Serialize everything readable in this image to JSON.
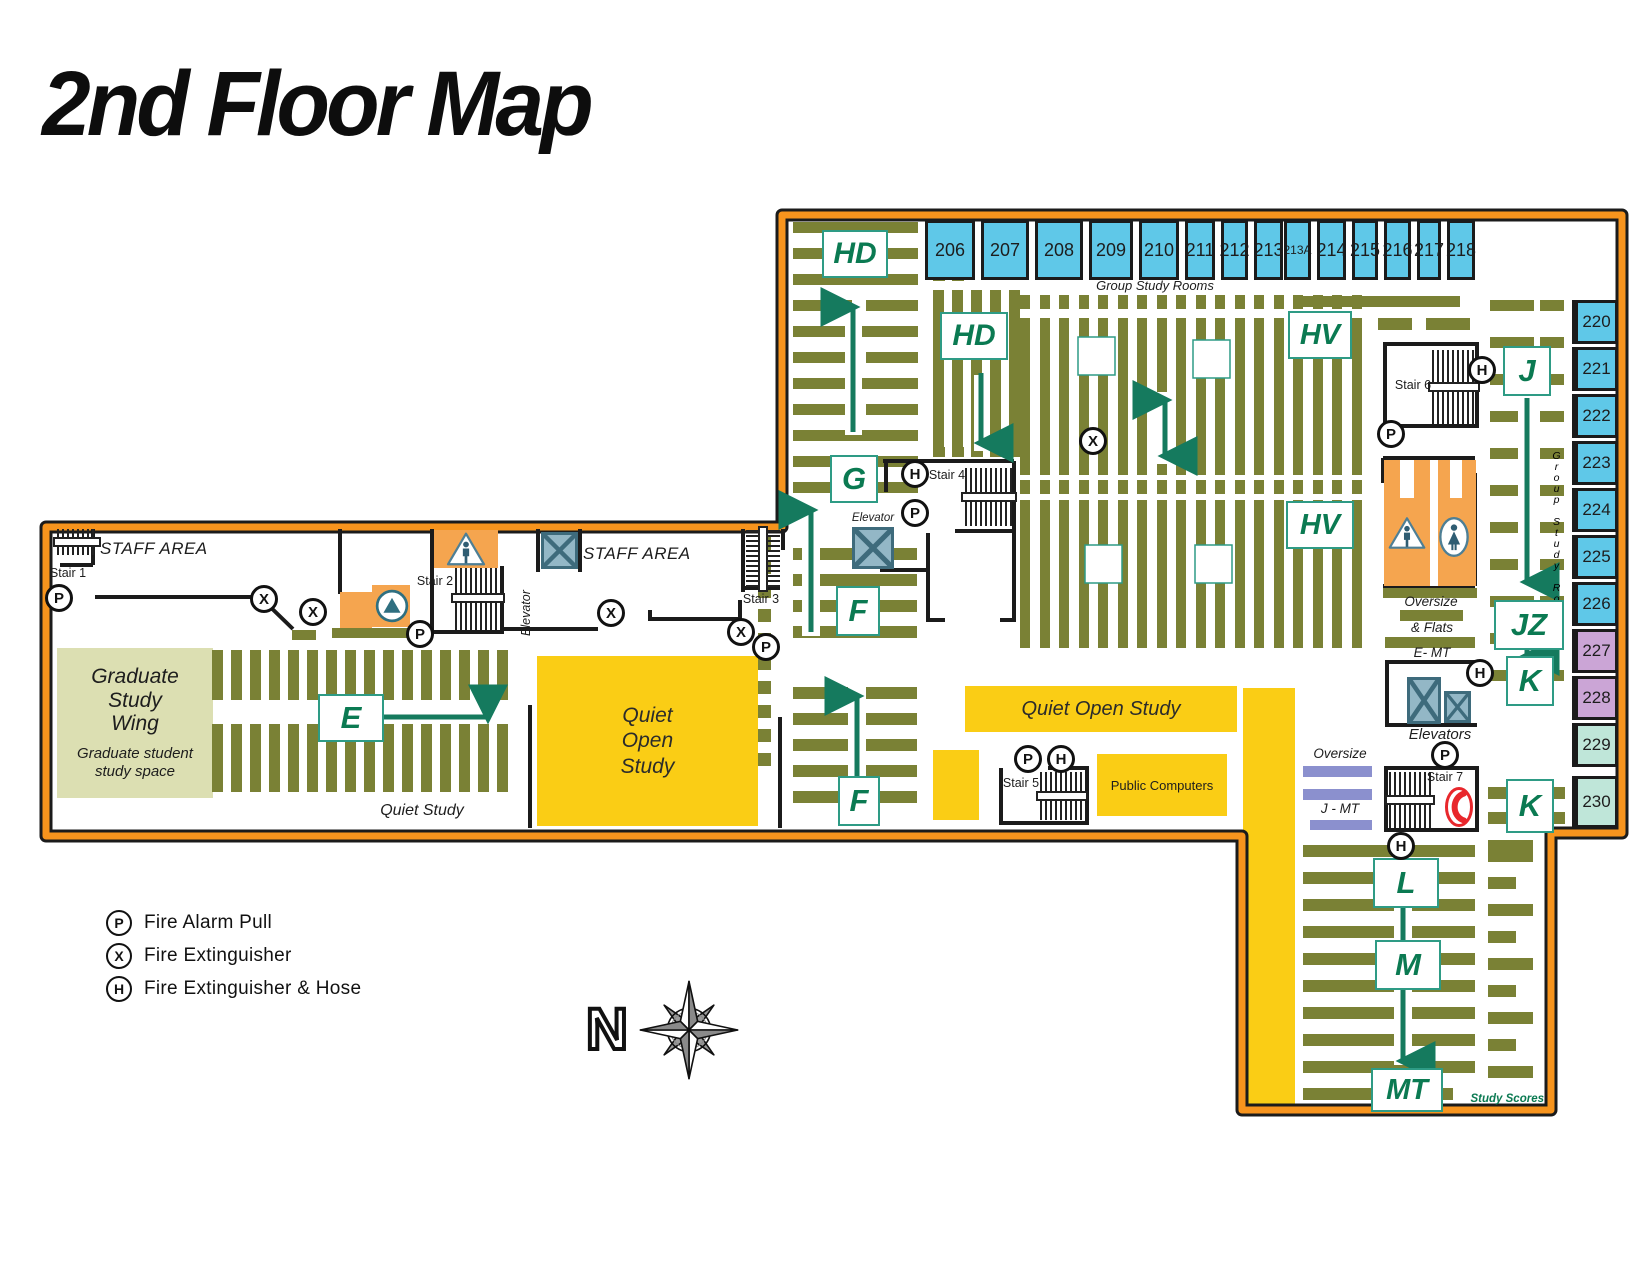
{
  "title": "2nd Floor Map",
  "rooms": {
    "top": [
      "206",
      "207",
      "208",
      "209",
      "210",
      "211",
      "212",
      "213",
      "213A",
      "214",
      "215",
      "216",
      "217",
      "218"
    ],
    "top_caption": "Group Study Rooms",
    "right": [
      "220",
      "221",
      "222",
      "223",
      "224",
      "225",
      "226",
      "227",
      "228",
      "229",
      "230"
    ],
    "right_caption": "Group Study Rooms"
  },
  "call_numbers": {
    "hd1": "HD",
    "hd2": "HD",
    "g": "G",
    "f1": "F",
    "f2": "F",
    "e": "E",
    "hv1": "HV",
    "hv2": "HV",
    "j": "J",
    "jz": "JZ",
    "k1": "K",
    "k2": "K",
    "l": "L",
    "m": "M",
    "mt": "MT"
  },
  "areas": {
    "graduate_title": "Graduate\nStudy\nWing",
    "graduate_subtitle": "Graduate student\nstudy space",
    "quiet_study": "Quiet Study",
    "quiet_open_study_main": "Quiet\nOpen\nStudy",
    "quiet_open_study_bar": "Quiet Open Study",
    "public_computers": "Public Computers",
    "study_scores": "Study Scores",
    "staff_area_1": "STAFF AREA",
    "staff_area_2": "STAFF AREA",
    "oversize_1": "Oversize",
    "flats": "& Flats",
    "e_mt": "E- MT",
    "oversize_2": "Oversize",
    "j_mt": "J - MT"
  },
  "facilities": {
    "stairs": [
      "Stair 1",
      "Stair 2",
      "Stair 3",
      "Stair 4",
      "Stair 5",
      "Stair 6",
      "Stair 7"
    ],
    "elevator_wing": "Elevator",
    "elevator_upper": "Elevator",
    "elevators": "Elevators"
  },
  "legend": [
    {
      "symbol": "P",
      "label": "Fire Alarm Pull"
    },
    {
      "symbol": "X",
      "label": "Fire Extinguisher"
    },
    {
      "symbol": "H",
      "label": "Fire Extinguisher & Hose"
    }
  ],
  "compass_label": "N",
  "colors": {
    "border_orange": "#F7941D",
    "stack_olive": "#7A8135",
    "room_blue": "#5FC8E8",
    "room_purple": "#CBA5D6",
    "room_teal": "#BFE6D9",
    "area_yellow": "#FACD15",
    "khaki": "#DCDFB2",
    "label_green": "#0B7A52",
    "orange_room": "#F5A54F",
    "elevator_blue": "#93B7C6",
    "phone_red": "#E8272C",
    "jmt_purple": "#8B90CE"
  }
}
